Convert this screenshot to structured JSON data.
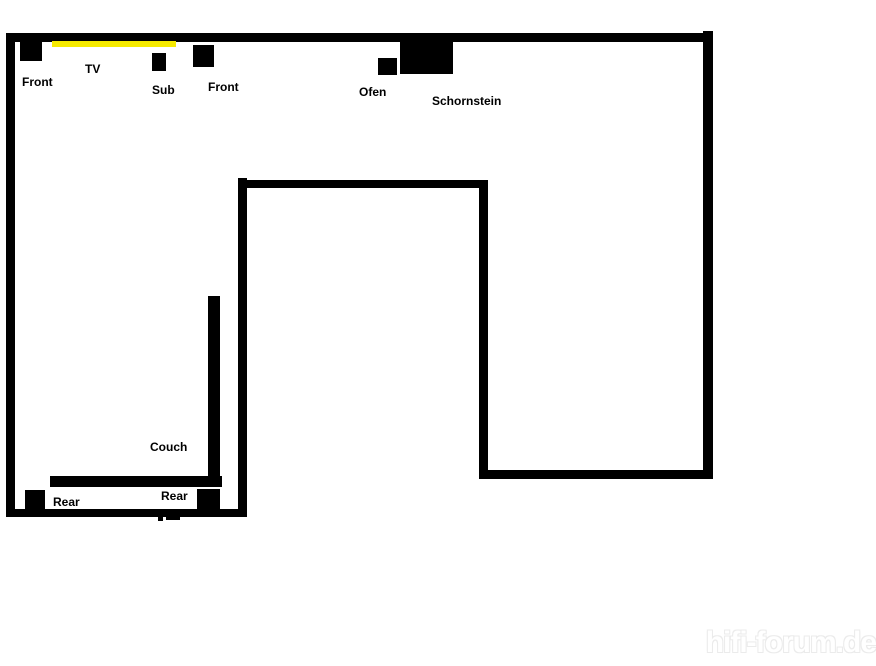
{
  "page": {
    "width": 876,
    "height": 666,
    "background": "#ffffff"
  },
  "colors": {
    "wall": "#000000",
    "object": "#000000",
    "tv_line": "#f6ea00",
    "label_text": "#000000",
    "watermark_outline": "#ebebeb"
  },
  "floorplan": {
    "walls": [
      {
        "name": "wall-top",
        "x": 6,
        "y": 33,
        "w": 707,
        "h": 9
      },
      {
        "name": "wall-left",
        "x": 6,
        "y": 33,
        "w": 9,
        "h": 484
      },
      {
        "name": "wall-right",
        "x": 703,
        "y": 31,
        "w": 10,
        "h": 448
      },
      {
        "name": "wall-bottom-left",
        "x": 6,
        "y": 509,
        "w": 241,
        "h": 8
      },
      {
        "name": "wall-stair-left",
        "x": 238,
        "y": 178,
        "w": 9,
        "h": 339
      },
      {
        "name": "wall-stair-top",
        "x": 238,
        "y": 180,
        "w": 249,
        "h": 8
      },
      {
        "name": "wall-stair-right",
        "x": 479,
        "y": 180,
        "w": 9,
        "h": 298
      },
      {
        "name": "wall-bottom-right",
        "x": 479,
        "y": 470,
        "w": 234,
        "h": 9
      }
    ],
    "objects": [
      {
        "name": "speaker-front-left-box",
        "x": 20,
        "y": 39,
        "w": 22,
        "h": 22,
        "color": "#000000"
      },
      {
        "name": "tv-screen-line",
        "x": 52,
        "y": 41,
        "w": 124,
        "h": 6,
        "color": "#f6ea00"
      },
      {
        "name": "speaker-sub-box",
        "x": 152,
        "y": 53,
        "w": 14,
        "h": 18,
        "color": "#000000"
      },
      {
        "name": "speaker-front-right-box",
        "x": 193,
        "y": 45,
        "w": 21,
        "h": 22,
        "color": "#000000"
      },
      {
        "name": "ofen-box",
        "x": 378,
        "y": 58,
        "w": 19,
        "h": 17,
        "color": "#000000"
      },
      {
        "name": "schornstein-box",
        "x": 400,
        "y": 40,
        "w": 53,
        "h": 34,
        "color": "#000000"
      },
      {
        "name": "couch-back-bar",
        "x": 208,
        "y": 296,
        "w": 12,
        "h": 191,
        "color": "#000000"
      },
      {
        "name": "couch-seat-bar",
        "x": 50,
        "y": 476,
        "w": 172,
        "h": 11,
        "color": "#000000"
      },
      {
        "name": "speaker-rear-left-box",
        "x": 25,
        "y": 490,
        "w": 20,
        "h": 19,
        "color": "#000000"
      },
      {
        "name": "speaker-rear-right-box",
        "x": 197,
        "y": 489,
        "w": 23,
        "h": 20,
        "color": "#000000"
      },
      {
        "name": "pen-smudge-1",
        "x": 158,
        "y": 516,
        "w": 5,
        "h": 5,
        "color": "#000000"
      },
      {
        "name": "pen-smudge-2",
        "x": 166,
        "y": 516,
        "w": 14,
        "h": 4,
        "color": "#000000"
      }
    ],
    "labels": [
      {
        "name": "label-front-left",
        "text": "Front",
        "x": 22,
        "y": 76
      },
      {
        "name": "label-tv",
        "text": "TV",
        "x": 85,
        "y": 63
      },
      {
        "name": "label-sub",
        "text": "Sub",
        "x": 152,
        "y": 84
      },
      {
        "name": "label-front-right",
        "text": "Front",
        "x": 208,
        "y": 81
      },
      {
        "name": "label-ofen",
        "text": "Ofen",
        "x": 359,
        "y": 86
      },
      {
        "name": "label-schornstein",
        "text": "Schornstein",
        "x": 432,
        "y": 95
      },
      {
        "name": "label-couch",
        "text": "Couch",
        "x": 150,
        "y": 441
      },
      {
        "name": "label-rear-left",
        "text": "Rear",
        "x": 53,
        "y": 496
      },
      {
        "name": "label-rear-right",
        "text": "Rear",
        "x": 161,
        "y": 490
      }
    ]
  },
  "watermark": {
    "text": "hifi-forum.de"
  }
}
